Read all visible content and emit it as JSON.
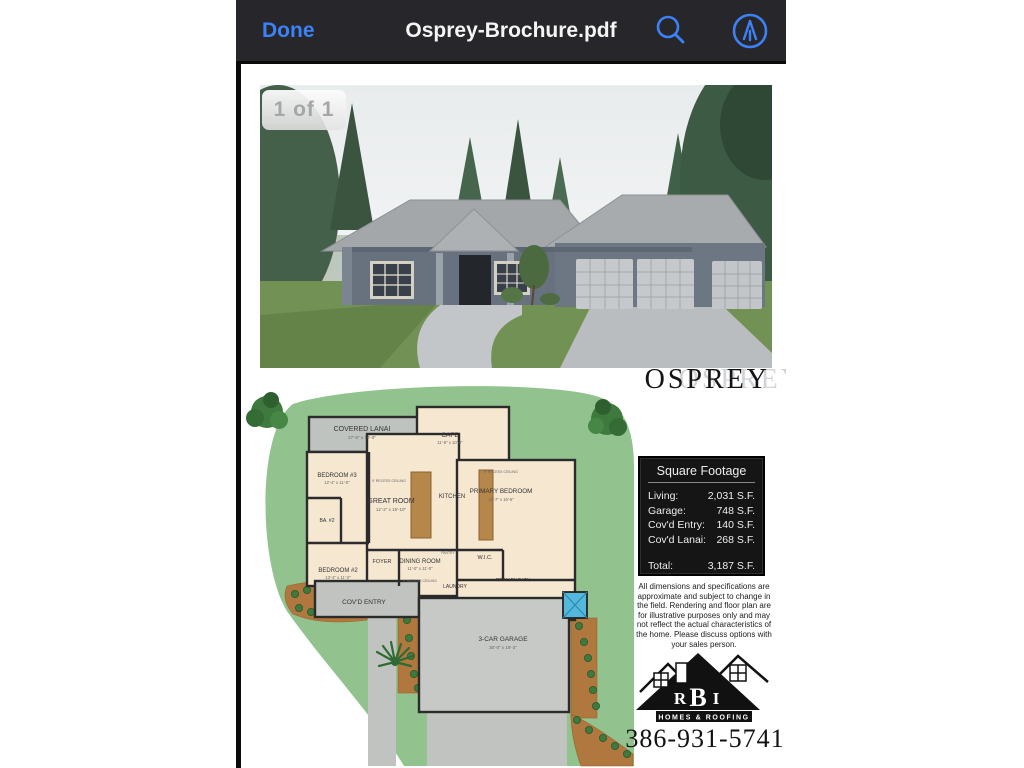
{
  "colors": {
    "accent_blue": "#3C82F7",
    "navbar_bg": "#27272B",
    "page_bg": "#FFFFFF",
    "lawn_green": "#92C28E",
    "plan_cream": "#F6E7D1",
    "plan_gray": "#C0C3BF",
    "sqft_panel_bg": "#151515"
  },
  "navbar": {
    "done_label": "Done",
    "title": "Osprey-Brochure.pdf",
    "icons": [
      "search-icon",
      "markup-icon"
    ]
  },
  "viewer": {
    "page_indicator": "1 of 1"
  },
  "brochure": {
    "model_name": "OSPREY",
    "square_footage": {
      "title": "Square Footage",
      "rows": [
        {
          "label": "Living:",
          "value": "2,031 S.F."
        },
        {
          "label": "Garage:",
          "value": "748 S.F."
        },
        {
          "label": "Cov'd Entry:",
          "value": "140 S.F."
        },
        {
          "label": "Cov'd Lanai:",
          "value": "268 S.F."
        }
      ],
      "total": {
        "label": "Total:",
        "value": "3,187 S.F."
      }
    },
    "disclaimer": "All dimensions and specifications are approximate and subject to change in the field. Rendering and floor plan are for illustrative purposes only and may not reflect the actual characteristics of the home. Please discuss options with your sales person.",
    "logo": {
      "letters": [
        "R",
        "B",
        "I"
      ],
      "tagline": "HOMES & ROOFING"
    },
    "phone": "386-931-5741",
    "floor_plan": {
      "ceiling_note": "9' RECESS CEILING",
      "rooms": [
        {
          "name": "COVERED LANAI",
          "dims": "27'-6\" x 10'-0\""
        },
        {
          "name": "CAFE",
          "dims": "11'-8\" x 10'-0\""
        },
        {
          "name": "BEDROOM #3",
          "dims": "12'-4\" x 11'-0\""
        },
        {
          "name": "GREAT ROOM",
          "dims": "12'-2\" x 15'-10\""
        },
        {
          "name": "KITCHEN"
        },
        {
          "name": "PRIMARY BEDROOM",
          "dims": "14'-7\" x 16'-5\""
        },
        {
          "name": "BA. #2"
        },
        {
          "name": "BEDROOM #2",
          "dims": "13'-4\" x 11'-2\""
        },
        {
          "name": "FOYER"
        },
        {
          "name": "DINING ROOM",
          "dims": "11'-0\" x 11'-0\""
        },
        {
          "name": "LAUNDRY"
        },
        {
          "name": "PANTRY"
        },
        {
          "name": "W.I.C."
        },
        {
          "name": "PRIMARY BATH"
        },
        {
          "name": "COV'D ENTRY"
        },
        {
          "name": "3-CAR GARAGE",
          "dims": "30'-0\" x 19'-2\""
        }
      ]
    }
  }
}
